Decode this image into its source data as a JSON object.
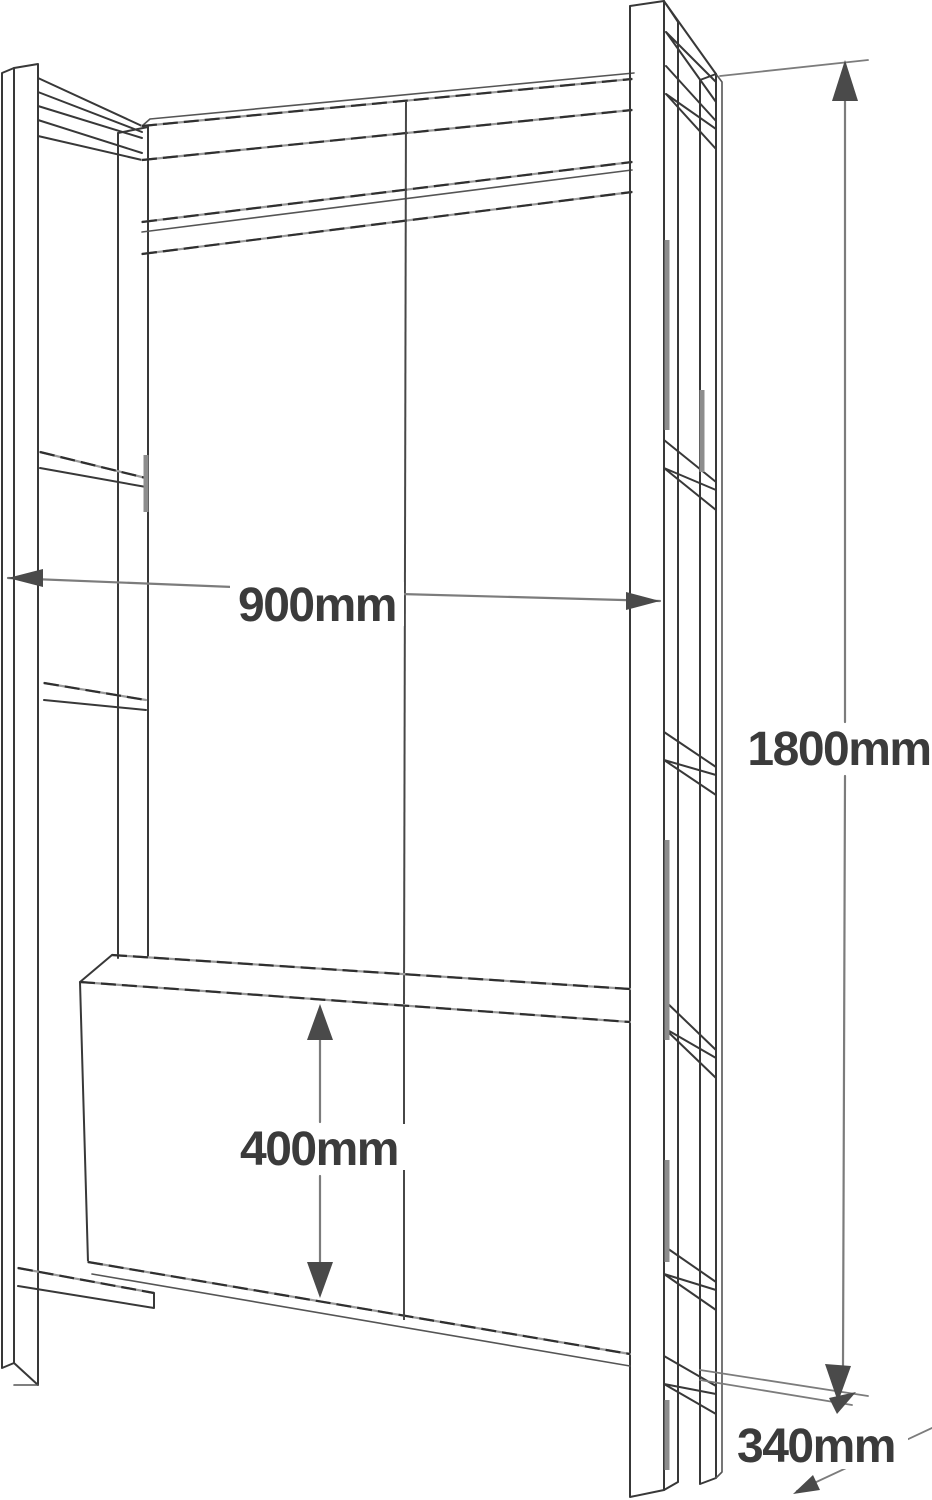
{
  "diagram": {
    "kind": "furniture-dimension-sketch",
    "labels": {
      "width": "900mm",
      "height": "1800mm",
      "cabinet_height": "400mm",
      "depth": "340mm"
    }
  },
  "colors": {
    "background": "#ffffff",
    "structure_line": "#383838",
    "long_edge_dark": "#2f2f2f",
    "long_edge_light": "#9b9b9b",
    "dimension_line": "#7c7c7c",
    "arrowhead": "#4a4a4a",
    "label_text": "#3b3b3b",
    "shading": "#8d8d8d"
  }
}
